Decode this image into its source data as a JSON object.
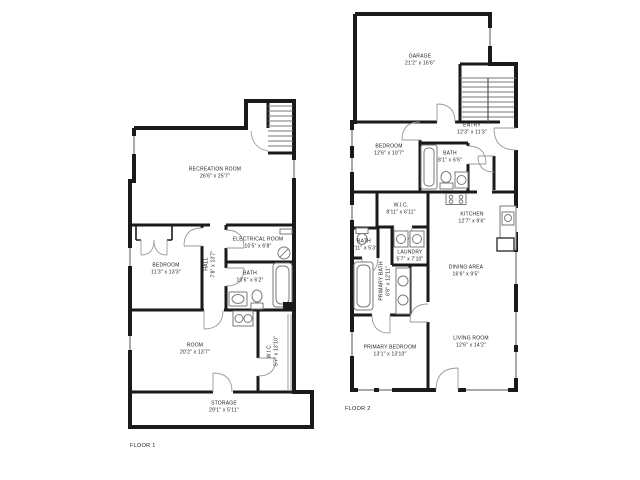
{
  "floor1": {
    "label": "FLOOR 1",
    "rooms": {
      "recreation": {
        "name": "RECREATION ROOM",
        "dims": "26'6\" x 25'7\""
      },
      "bedroom": {
        "name": "BEDROOM",
        "dims": "11'3\" x 13'3\""
      },
      "electrical": {
        "name": "ELECTRICAL ROOM",
        "dims": "10'5\" x 6'8\""
      },
      "hall": {
        "name": "HALL",
        "dims": "7'8\" x 13'7\""
      },
      "bath": {
        "name": "BATH",
        "dims": "10'6\" x 6'2\""
      },
      "room": {
        "name": "ROOM",
        "dims": "20'2\" x 13'7\""
      },
      "wic": {
        "name": "W.I.C.",
        "dims": "5'7\" x 13'10\""
      },
      "storage": {
        "name": "STORAGE",
        "dims": "29'1\" x 5'11\""
      }
    }
  },
  "floor2": {
    "label": "FLOOR 2",
    "rooms": {
      "garage": {
        "name": "GARAGE",
        "dims": "21'2\" x 16'6\""
      },
      "entry": {
        "name": "ENTRY",
        "dims": "12'3\" x 11'3\""
      },
      "bedroom": {
        "name": "BEDROOM",
        "dims": "12'6\" x 10'7\""
      },
      "bath": {
        "name": "BATH",
        "dims": "8'1\" x 6'6\""
      },
      "wic": {
        "name": "W.I.C.",
        "dims": "8'11\" x 6'11\""
      },
      "bath_small": {
        "name": "BATH",
        "dims": "3'11\" x 5'3\""
      },
      "laundry": {
        "name": "LAUNDRY",
        "dims": "5'7\" x 7'10\""
      },
      "primary_bath": {
        "name": "PRIMARY BATH",
        "dims": "6'8\" x 12'11\""
      },
      "kitchen": {
        "name": "KITCHEN",
        "dims": "12'7\" x 9'6\""
      },
      "dining": {
        "name": "DINING AREA",
        "dims": "16'6\" x 9'5\""
      },
      "living": {
        "name": "LIVING ROOM",
        "dims": "12'6\" x 14'2\""
      },
      "primary_bedroom": {
        "name": "PRIMARY BEDROOM",
        "dims": "13'1\" x 13'10\""
      }
    }
  },
  "colors": {
    "wall": "#1a1a1a",
    "door": "#9a9a9a",
    "fixture": "#7a7a7a",
    "text": "#222222"
  }
}
